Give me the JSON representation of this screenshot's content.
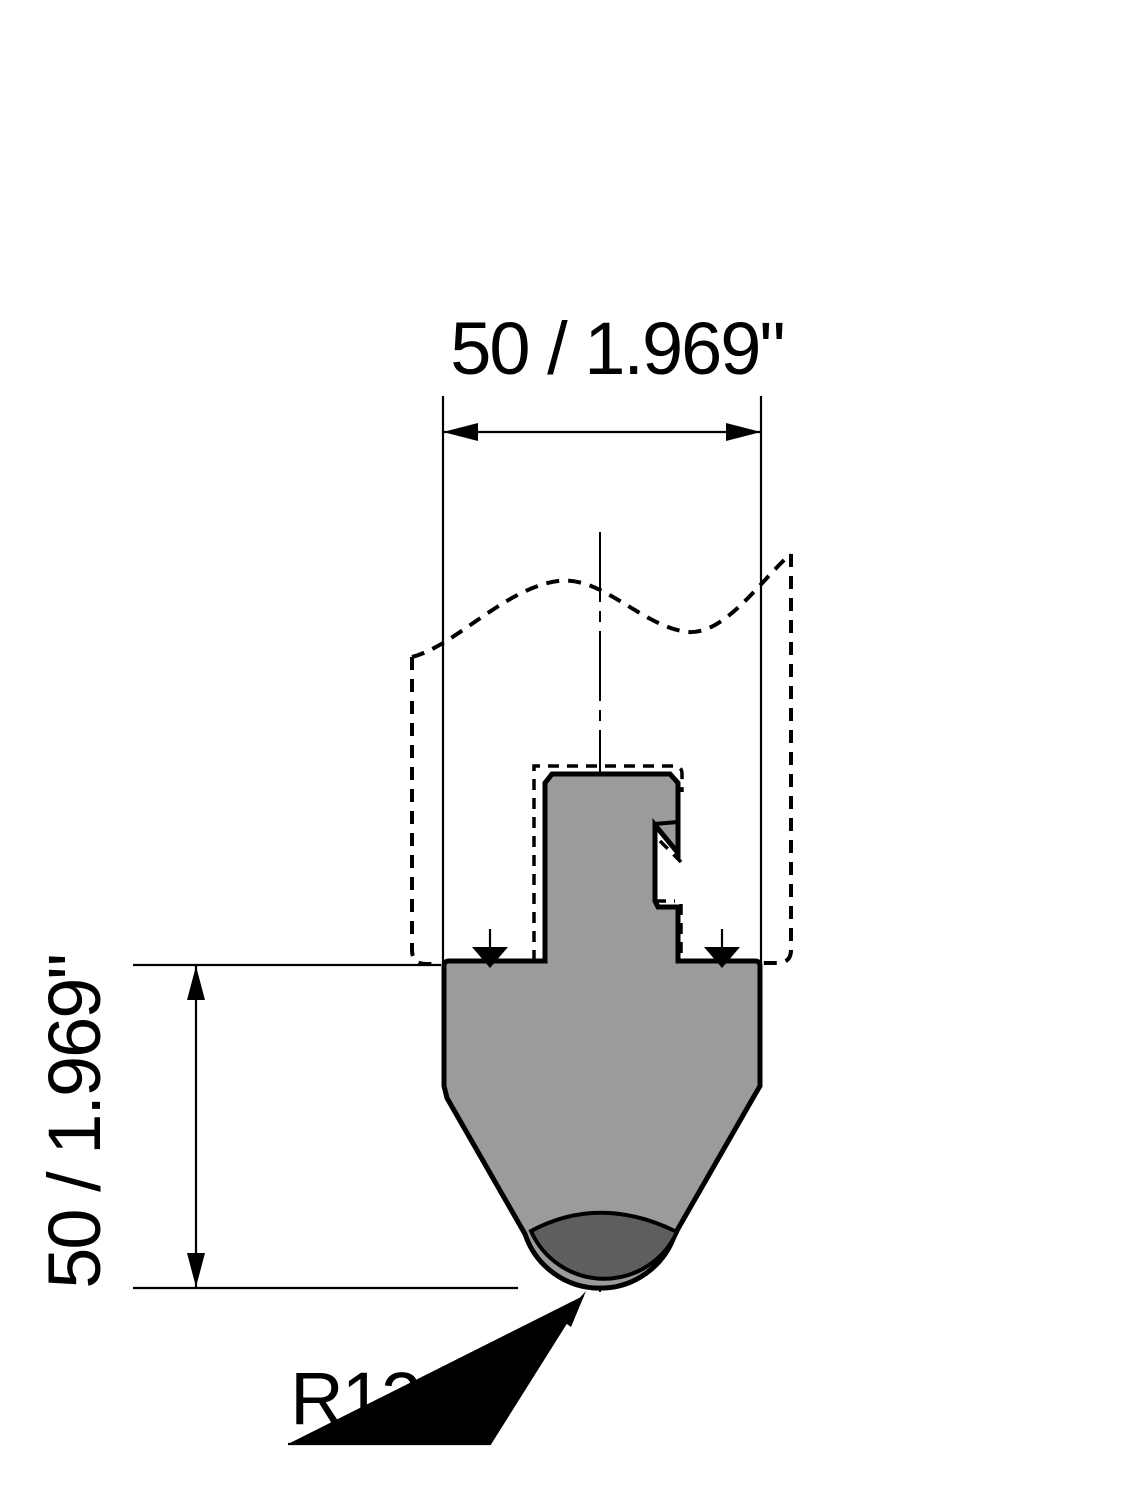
{
  "drawing": {
    "dimensions": {
      "top_width_label": "50 / 1.969\"",
      "left_height_label": "50 / 1.969\"",
      "tip_radius_label": "R12.5"
    },
    "colors": {
      "background": "#ffffff",
      "line": "#000000",
      "body_fill": "#9b9b9b",
      "tip_fill": "#5e5e5e"
    }
  }
}
